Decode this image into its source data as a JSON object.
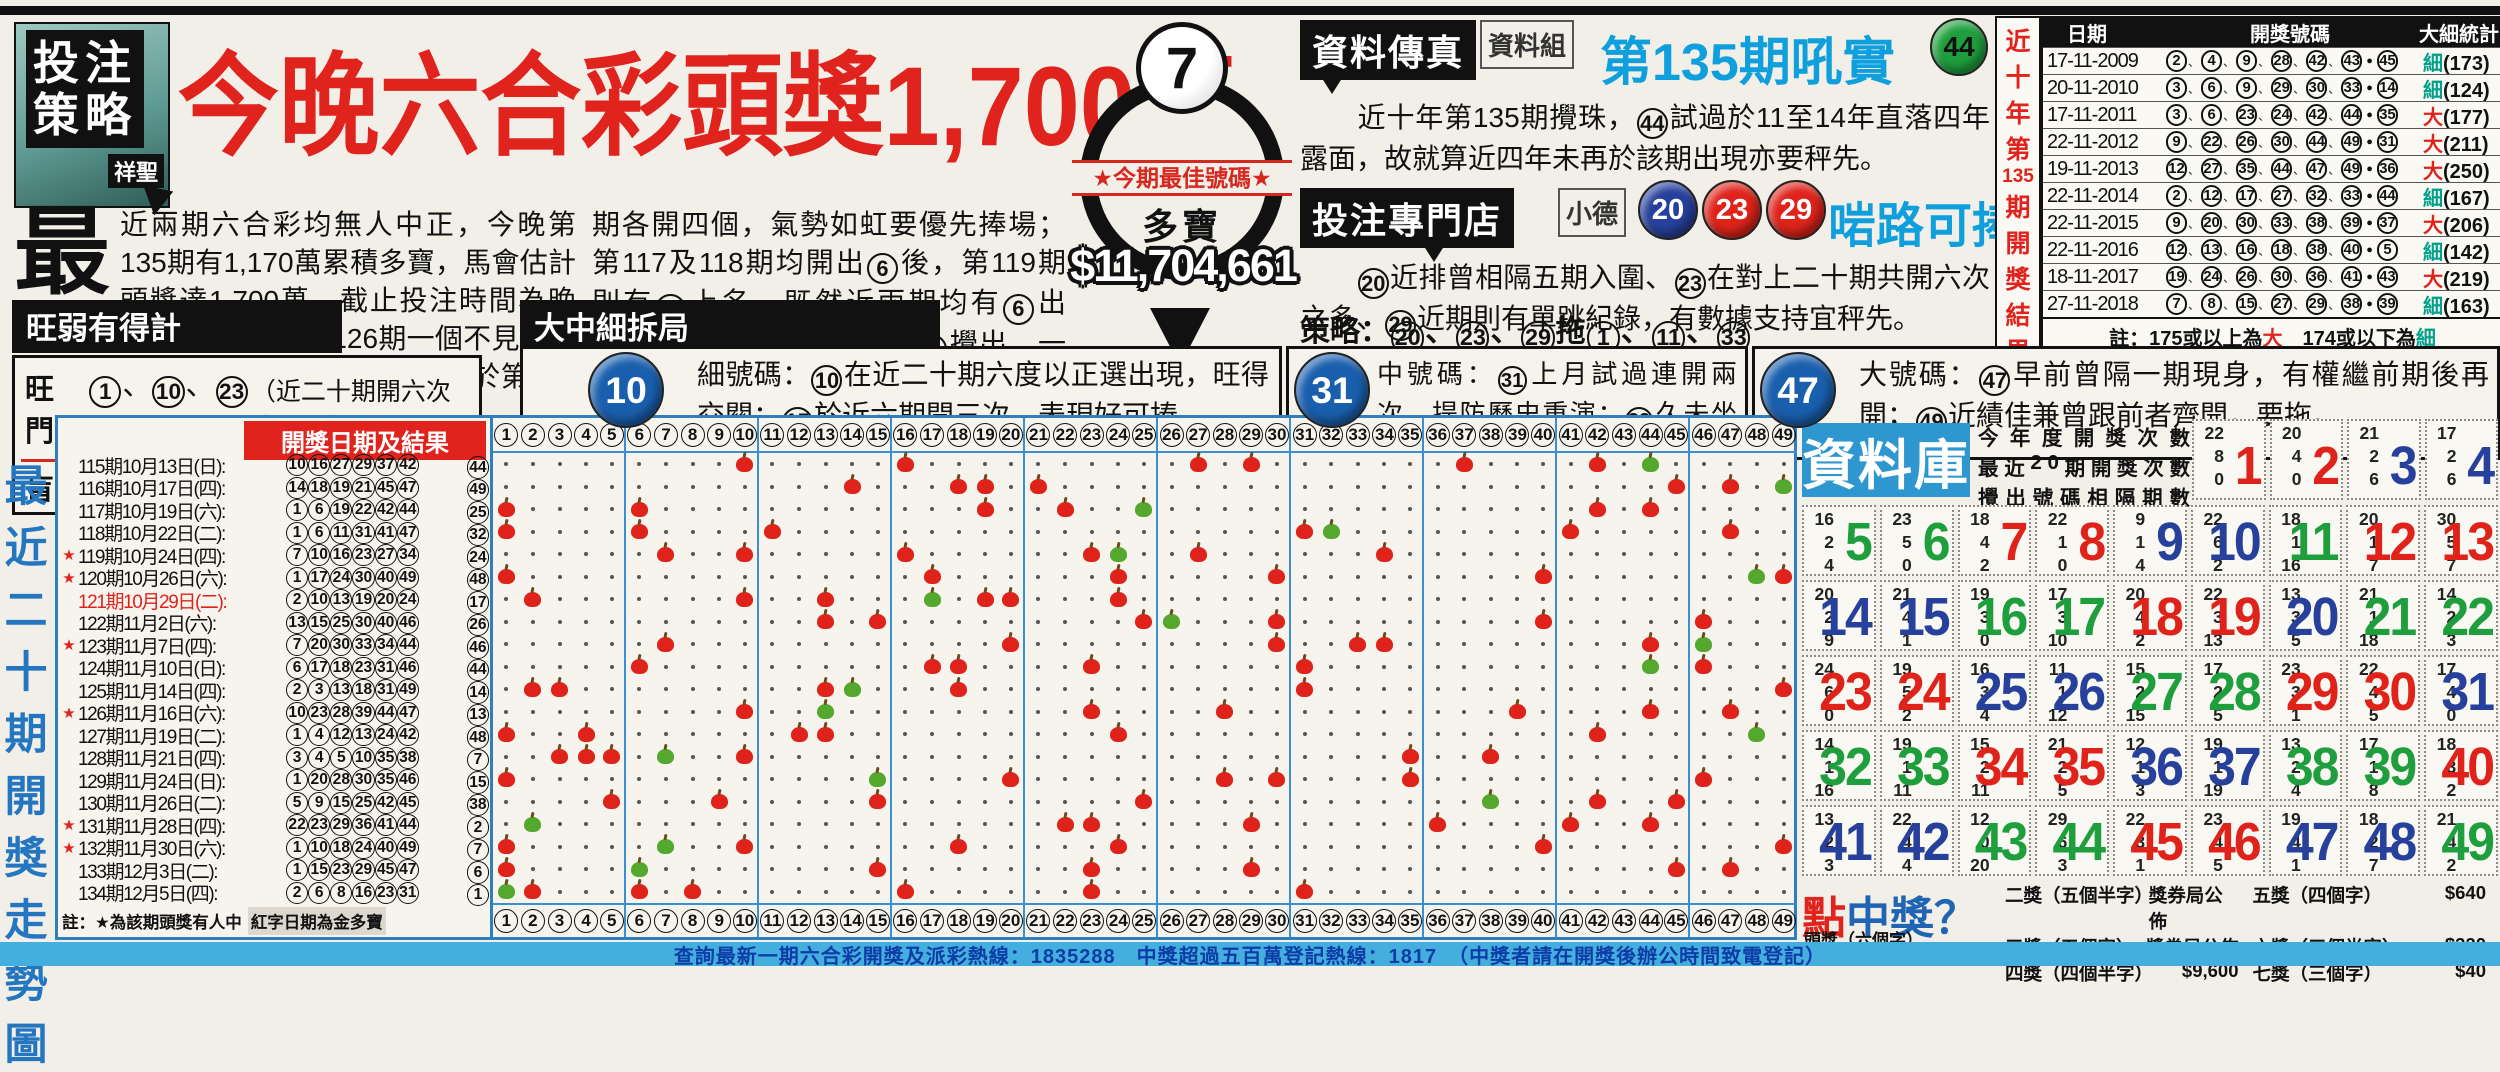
{
  "masthead": {
    "logo": {
      "line1": "投注",
      "line2": "策略",
      "tag": "祥聖"
    },
    "headline": "今晚六合彩頭獎1,700萬",
    "drop_cap": "最",
    "para1": "近兩期六合彩均無人中正，今晚第135期有1,170萬累積多寶，馬會估計頭獎達1,700萬，截止投注時間為晚上9:15。",
    "para2_col1": "　　個位數在第126期一個不見後，跟住八期皆見同類分子露面，期間更於第128及上",
    "para2_col2": "期各開四個，氣勢如虹要優先捧場；第117及118期均開出{6}後，第119期則有{7}上名，既然近兩期均有{6}出現，捉路今晚隨時又輪到{7}攪出，一於博它相隔兩期後重現眼前。"
  },
  "best": {
    "ball": "7",
    "banner": "★今期最佳號碼★",
    "label": "多寶",
    "amount": "$11,704,661"
  },
  "fax": {
    "header": "資料傳真",
    "tag": "資料組",
    "title": "第135期吼實",
    "ball": 44,
    "body": "　　近十年第135期攪珠，{44}試過於11至14年直落四年露面，故就算近四年未再於該期出現亦要秤先。"
  },
  "shop": {
    "header": "投注專門店",
    "tag": "小德",
    "balls": [
      20,
      23,
      29
    ],
    "title": "啱路可捧",
    "body": "　　{20}近排曾相隔五期入圍、{23}在對上二十期共開六次之多、{29}近期則有單跳紀錄，有數據支持宜秤先。",
    "strategy": "策略：{20}、{23}、{29}拖{1}、{11}、{33}、{42}、{45}（共10注）"
  },
  "hotcold": {
    "header": "旺弱有得計",
    "hot_label": "旺門：",
    "hot_nums": "{1}、{10}、{23}、{44}",
    "hot_note": "（近二十期開六次或以上）",
    "cold_label": "盲門：",
    "cold_nums": "{43}",
    "cold_note": "（近二十期未開出）"
  },
  "sizes": {
    "header": "大中細拆局",
    "items": [
      {
        "ball": 10,
        "body": "細號碼：{10}在近二十期六度以正選出現，旺得交關；{15}於近六期開三次，表現好可捧。"
      },
      {
        "ball": 31,
        "body": "中號碼：{31}上月試過連開兩次，提防歷史重演；{32}久未坐正，係時候博這綠波重開。"
      },
      {
        "ball": 47,
        "body": "大號碼：{47}早前曾隔一期現身，有權繼前期後再開；{49}近績佳兼曾跟前者齊開，要拖。"
      }
    ]
  },
  "tenyear": {
    "side_title": [
      "近",
      "十",
      "年",
      "第",
      "135",
      "期",
      "開",
      "獎",
      "結",
      "果"
    ],
    "headers": [
      "日期",
      "開獎號碼",
      "大細統計"
    ],
    "rows": [
      {
        "date": "17-11-2009",
        "nums": [
          2,
          4,
          9,
          28,
          42,
          43
        ],
        "special": 45,
        "size": "細",
        "total": 173
      },
      {
        "date": "20-11-2010",
        "nums": [
          3,
          6,
          9,
          29,
          30,
          33
        ],
        "special": 14,
        "size": "細",
        "total": 124
      },
      {
        "date": "17-11-2011",
        "nums": [
          3,
          6,
          23,
          24,
          42,
          44
        ],
        "special": 35,
        "size": "大",
        "total": 177
      },
      {
        "date": "22-11-2012",
        "nums": [
          9,
          22,
          26,
          30,
          44,
          49
        ],
        "special": 31,
        "size": "大",
        "total": 211
      },
      {
        "date": "19-11-2013",
        "nums": [
          12,
          27,
          35,
          44,
          47,
          49
        ],
        "special": 36,
        "size": "大",
        "total": 250
      },
      {
        "date": "22-11-2014",
        "nums": [
          2,
          12,
          17,
          27,
          32,
          33
        ],
        "special": 44,
        "size": "細",
        "total": 167
      },
      {
        "date": "22-11-2015",
        "nums": [
          9,
          20,
          30,
          33,
          38,
          39
        ],
        "special": 37,
        "size": "大",
        "total": 206
      },
      {
        "date": "22-11-2016",
        "nums": [
          12,
          13,
          16,
          18,
          38,
          40
        ],
        "special": 5,
        "size": "細",
        "total": 142
      },
      {
        "date": "18-11-2017",
        "nums": [
          19,
          24,
          26,
          30,
          36,
          41
        ],
        "special": 43,
        "size": "大",
        "total": 219
      },
      {
        "date": "27-11-2018",
        "nums": [
          7,
          8,
          15,
          27,
          29,
          38
        ],
        "special": 39,
        "size": "細",
        "total": 163
      }
    ],
    "note": {
      "pre": "註：175或以上為",
      "big": "大",
      "mid": "　174或以下為",
      "small": "細"
    }
  },
  "trend": {
    "side_title": [
      "最",
      "近",
      "二",
      "十",
      "期",
      "開",
      "獎",
      "走",
      "勢",
      "圖"
    ],
    "panel_header": "開獎日期及結果",
    "draws": [
      {
        "period": 115,
        "date": "10月13日",
        "week": "日",
        "star": false,
        "gold": false,
        "nums": [
          10,
          16,
          27,
          29,
          37,
          42
        ],
        "special": 44
      },
      {
        "period": 116,
        "date": "10月17日",
        "week": "四",
        "star": false,
        "gold": false,
        "nums": [
          14,
          18,
          19,
          21,
          45,
          47
        ],
        "special": 49
      },
      {
        "period": 117,
        "date": "10月19日",
        "week": "六",
        "star": false,
        "gold": false,
        "nums": [
          1,
          6,
          19,
          22,
          42,
          44
        ],
        "special": 25
      },
      {
        "period": 118,
        "date": "10月22日",
        "week": "二",
        "star": false,
        "gold": false,
        "nums": [
          1,
          6,
          11,
          31,
          41,
          47
        ],
        "special": 32
      },
      {
        "period": 119,
        "date": "10月24日",
        "week": "四",
        "star": true,
        "gold": false,
        "nums": [
          7,
          10,
          16,
          23,
          27,
          34
        ],
        "special": 24
      },
      {
        "period": 120,
        "date": "10月26日",
        "week": "六",
        "star": true,
        "gold": false,
        "nums": [
          1,
          17,
          24,
          30,
          40,
          49
        ],
        "special": 48
      },
      {
        "period": 121,
        "date": "10月29日",
        "week": "二",
        "star": false,
        "gold": true,
        "nums": [
          2,
          10,
          13,
          19,
          20,
          24
        ],
        "special": 17
      },
      {
        "period": 122,
        "date": "11月2日",
        "week": "六",
        "star": false,
        "gold": false,
        "nums": [
          13,
          15,
          25,
          30,
          40,
          46
        ],
        "special": 26
      },
      {
        "period": 123,
        "date": "11月7日",
        "week": "四",
        "star": true,
        "gold": false,
        "nums": [
          7,
          20,
          30,
          33,
          34,
          44
        ],
        "special": 46
      },
      {
        "period": 124,
        "date": "11月10日",
        "week": "日",
        "star": false,
        "gold": false,
        "nums": [
          6,
          17,
          18,
          23,
          31,
          46
        ],
        "special": 44
      },
      {
        "period": 125,
        "date": "11月14日",
        "week": "四",
        "star": false,
        "gold": false,
        "nums": [
          2,
          3,
          13,
          18,
          31,
          49
        ],
        "special": 14
      },
      {
        "period": 126,
        "date": "11月16日",
        "week": "六",
        "star": true,
        "gold": false,
        "nums": [
          10,
          23,
          28,
          39,
          44,
          47
        ],
        "special": 13
      },
      {
        "period": 127,
        "date": "11月19日",
        "week": "二",
        "star": false,
        "gold": false,
        "nums": [
          1,
          4,
          12,
          13,
          24,
          42
        ],
        "special": 48
      },
      {
        "period": 128,
        "date": "11月21日",
        "week": "四",
        "star": false,
        "gold": false,
        "nums": [
          3,
          4,
          5,
          10,
          35,
          38
        ],
        "special": 7
      },
      {
        "period": 129,
        "date": "11月24日",
        "week": "日",
        "star": false,
        "gold": false,
        "nums": [
          1,
          20,
          28,
          30,
          35,
          46
        ],
        "special": 15
      },
      {
        "period": 130,
        "date": "11月26日",
        "week": "二",
        "star": false,
        "gold": false,
        "nums": [
          5,
          9,
          15,
          25,
          42,
          45
        ],
        "special": 38
      },
      {
        "period": 131,
        "date": "11月28日",
        "week": "四",
        "star": true,
        "gold": false,
        "nums": [
          22,
          23,
          29,
          36,
          41,
          44
        ],
        "special": 2
      },
      {
        "period": 132,
        "date": "11月30日",
        "week": "六",
        "star": true,
        "gold": false,
        "nums": [
          1,
          10,
          18,
          24,
          40,
          49
        ],
        "special": 7
      },
      {
        "period": 133,
        "date": "12月3日",
        "week": "二",
        "star": false,
        "gold": false,
        "nums": [
          1,
          15,
          23,
          29,
          45,
          47
        ],
        "special": 6
      },
      {
        "period": 134,
        "date": "12月5日",
        "week": "四",
        "star": false,
        "gold": false,
        "nums": [
          2,
          6,
          8,
          16,
          23,
          31
        ],
        "special": 1
      }
    ],
    "note_a": "註：★為該期頭獎有人中",
    "note_b": "紅字日期為金多寶"
  },
  "database": {
    "title": "資料庫",
    "labels": [
      "今年度開獎次數",
      "最近20期開獎次數",
      "攪出號碼相隔期數"
    ],
    "year_counts": [
      22,
      20,
      21,
      17,
      16,
      23,
      18,
      22,
      9,
      22,
      18,
      20,
      30,
      20,
      21,
      19,
      17,
      20,
      22,
      13,
      21,
      14,
      24,
      19,
      16,
      11,
      15,
      17,
      23,
      22,
      17,
      14,
      19,
      15,
      21,
      12,
      19,
      13,
      17,
      18,
      13,
      22,
      12,
      29,
      22,
      23,
      19,
      18,
      21
    ]
  },
  "prizes": {
    "title_red": "點",
    "title_blue": "中獎？",
    "first_label": "頭獎（六個字）",
    "rows": [
      [
        {
          "label": "二獎（五個半字）",
          "value": "獎券局公佈"
        },
        {
          "label": "五獎（四個字）",
          "value": "$640"
        }
      ],
      [
        {
          "label": "三獎（五個字）",
          "value": "獎券局公佈"
        },
        {
          "label": "六獎（三個半字）",
          "value": "$320"
        }
      ],
      [
        {
          "label": "四獎（四個半字）",
          "value": "$9,600"
        },
        {
          "label": "七獎（三個字）",
          "value": "$40"
        }
      ]
    ]
  },
  "hotline": "查詢最新一期六合彩開獎及派彩熱線：1835288　中獎超過五百萬登記熱線：1817　（中獎者請在開獎後辦公時間致電登記）"
}
